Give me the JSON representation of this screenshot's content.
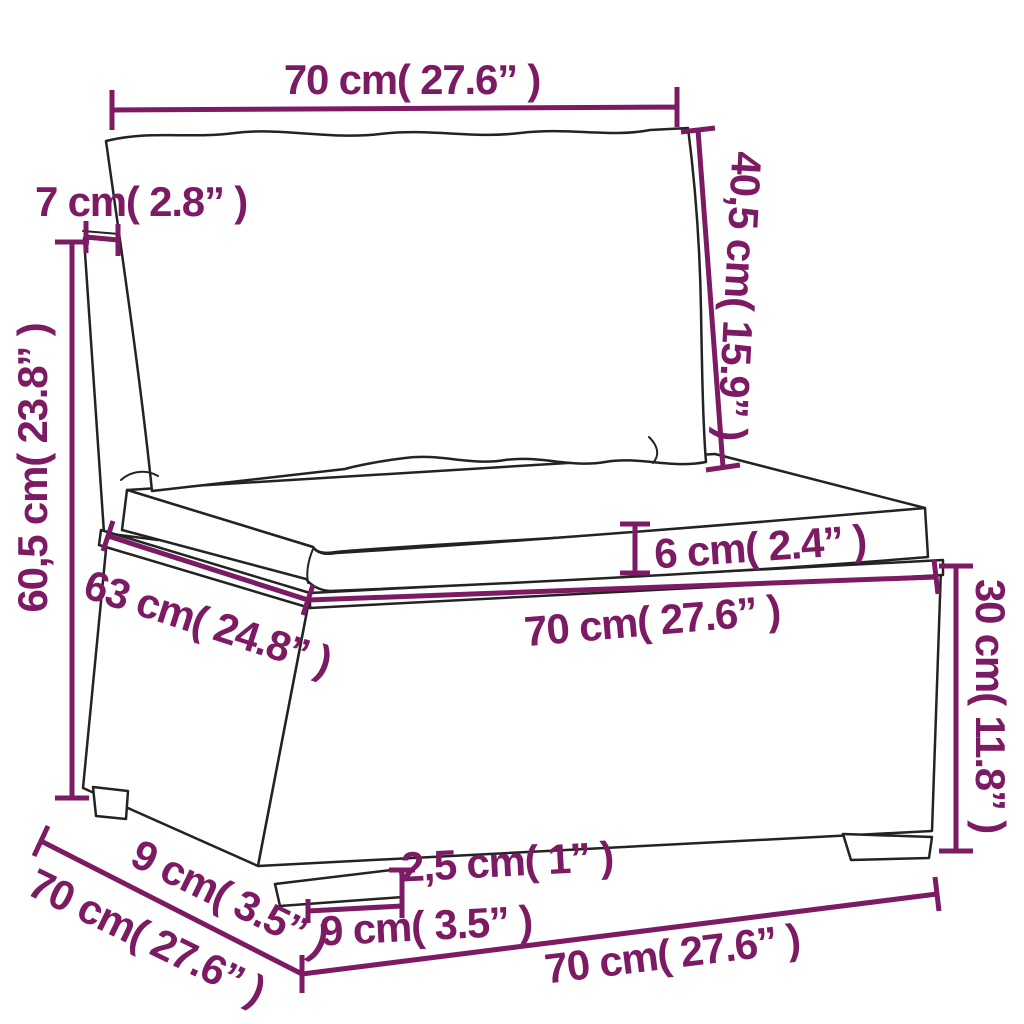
{
  "diagram": {
    "kind": "product-dimension-drawing",
    "subject": "poly rattan middle sofa section with back and seat cushions (line drawing)",
    "colors": {
      "dimension_annotations": "#7C1B64",
      "line_art": "#232323",
      "background": "#FFFFFF"
    },
    "dimensions": {
      "cushion_width": {
        "label": "70 cm( 27.6” )",
        "cm": 70,
        "inch": 27.6
      },
      "back_thickness": {
        "label": "7 cm( 2.8” )",
        "cm": 7,
        "inch": 2.8
      },
      "back_cushion_height": {
        "label": "40,5 cm( 15.9” )",
        "cm": 40.5,
        "inch": 15.9
      },
      "total_height": {
        "label": "60,5 cm( 23.8” )",
        "cm": 60.5,
        "inch": 23.8
      },
      "seat_cushion_thickness": {
        "label": "6 cm( 2.4” )",
        "cm": 6,
        "inch": 2.4
      },
      "seat_depth": {
        "label": "63 cm( 24.8” )",
        "cm": 63,
        "inch": 24.8
      },
      "seat_width": {
        "label": "70 cm( 27.6” )",
        "cm": 70,
        "inch": 27.6
      },
      "base_height": {
        "label": "30 cm( 11.8” )",
        "cm": 30,
        "inch": 11.8
      },
      "foot_inset": {
        "label": "9 cm( 3.5” )",
        "cm": 9,
        "inch": 3.5
      },
      "total_depth": {
        "label": "70 cm( 27.6” )",
        "cm": 70,
        "inch": 27.6
      },
      "foot_height": {
        "label": "2,5 cm( 1” )",
        "cm": 2.5,
        "inch": 1
      },
      "foot_width": {
        "label": "9 cm( 3.5” )",
        "cm": 9,
        "inch": 3.5
      },
      "total_width": {
        "label": "70 cm( 27.6” )",
        "cm": 70,
        "inch": 27.6
      }
    }
  }
}
